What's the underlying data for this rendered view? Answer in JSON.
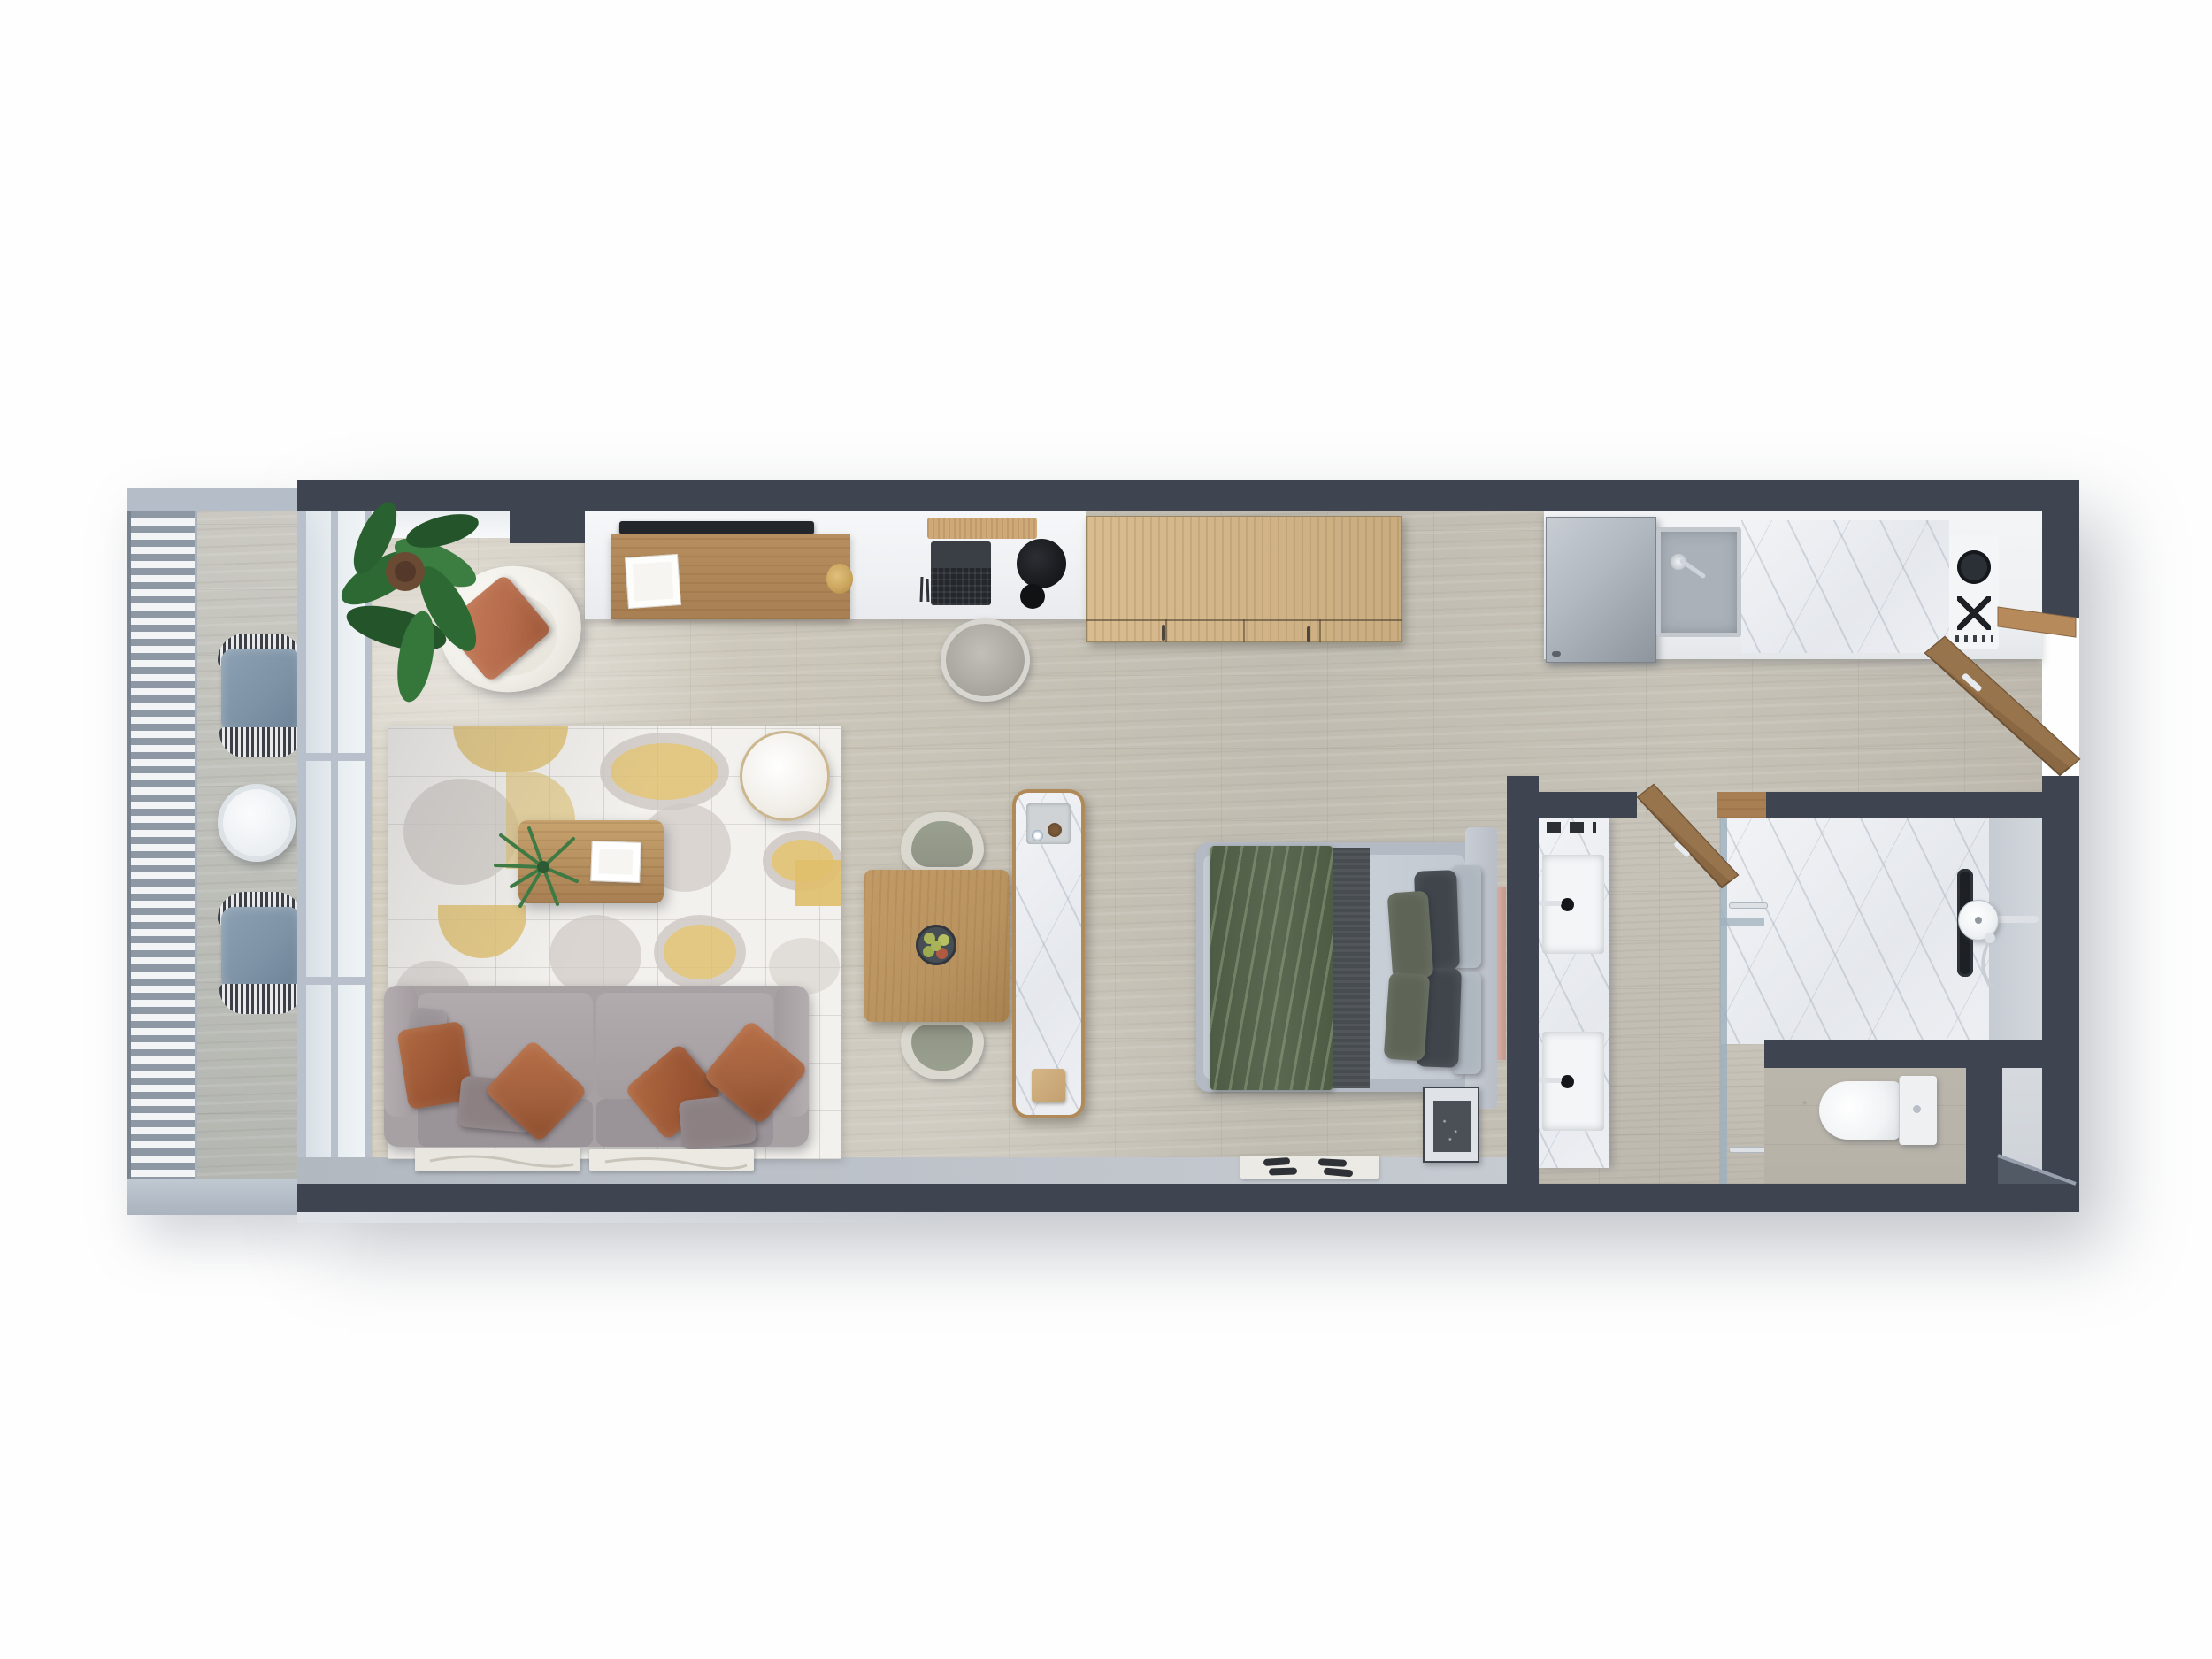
{
  "scene": {
    "type": "3d-floor-plan-top-down-render",
    "title": "Studio apartment 3D floor plan",
    "background": "#fefefe",
    "visible_text": "none"
  },
  "palette": {
    "wall": "#3e4550",
    "wall-light": "#525a66",
    "wall-edge": "#97a0ac",
    "balcony-wall": "#b4bdc8",
    "slab": "#c0c8d1",
    "louver": "#8e98a5",
    "frame": "#b8c1cb",
    "glass": "#ccdbe3",
    "walkway": "#bcc2ca",
    "entry-floor": "#ced3d9",
    "niche-floor": "#b6b2a8",
    "counter": "#eef0f2",
    "vein": "#9aa5b5",
    "wood": "#b98f60",
    "wood-light": "#d9bc8f",
    "wood-dark": "#8d6b47",
    "wood-door": "#8a6844",
    "tray": "#cfa977",
    "tv": "#23262b",
    "steel": "#b3bac2",
    "steel-dark": "#8e959d",
    "sofa": "#a8a1a4",
    "sofa-dark": "#9a9397",
    "pillow-rust": "#9b5634",
    "pillow-rust2": "#a4613e",
    "pillow-taupe": "#8c8083",
    "rug-base": "#f3f1ed",
    "rug-gray": "#cfc9c4",
    "rug-yellow": "#e0bf6a",
    "chair-white": "#f1efe9",
    "chair-pillow": "#b66c4b",
    "plant-green": "#2f6d34",
    "plant-dark": "#24552a",
    "pot-brown": "#6b4a33",
    "bed-frame": "#b4bac4",
    "mattress": "#c9cfd7",
    "throw-green": "#5a6851",
    "throw-sheen": "#8fa183",
    "blanket-dark": "#474c50",
    "pillow-sage": "#5e6557",
    "pillow-charcoal": "#3f454b",
    "pillow-light": "#aeb6bf",
    "copper": "#c49a90",
    "nightstand": "#dfe2e6",
    "art-dark": "#4b5056",
    "mat-white": "#eceae5",
    "slipper": "#2e3237",
    "toilet": "#f1f3f5",
    "cushion-blue": "#7e93a6",
    "wicker-dark": "#3c4046",
    "table-wood": "#b9935f",
    "chair-shell": "#dbd8d0",
    "chair-seat": "#8f9486",
    "bowl": "#474d54",
    "apple-green": "#a8b457",
    "apple-red": "#b05a41",
    "gold": "#c9a35b",
    "cooktop": "#1d2126",
    "chrome": "#dde1e6",
    "panel-art": "#e9e6df"
  },
  "rooms": [
    {
      "name": "balcony",
      "furniture": [
        "wicker-lounge-chair",
        "wicker-lounge-chair",
        "round-side-table",
        "louver-screen",
        "sliding-glass-wall"
      ]
    },
    {
      "name": "living-room",
      "furniture": [
        "two-seat-sofa",
        "rust-pillows",
        "patterned-rug",
        "coffee-table",
        "pouf",
        "swivel-armchair",
        "potted-plant",
        "tv-console",
        "tv",
        "art-panels"
      ]
    },
    {
      "name": "workspace",
      "furniture": [
        "desk",
        "laptop",
        "desk-lamp",
        "desk-chair",
        "wardrobe-cabinet"
      ]
    },
    {
      "name": "dining-area",
      "furniture": [
        "square-dining-table",
        "dining-chair",
        "dining-chair",
        "fruit-bowl",
        "marble-island-console"
      ]
    },
    {
      "name": "kitchen",
      "furniture": [
        "fridge",
        "sink",
        "marble-counter",
        "two-burner-cooktop",
        "entrance-door-open"
      ]
    },
    {
      "name": "bedroom",
      "furniture": [
        "double-bed",
        "green-throw",
        "pillows",
        "nightstand",
        "bedside-mat",
        "slippers",
        "copper-wall-panel"
      ]
    },
    {
      "name": "bathroom",
      "furniture": [
        "double-sink-vanity",
        "walk-in-shower",
        "rain-shower-head",
        "linear-drain",
        "glass-partition",
        "towel-bars",
        "toilet",
        "bathroom-door-open"
      ]
    },
    {
      "name": "entry",
      "furniture": [
        "chamfered-wall"
      ]
    }
  ]
}
